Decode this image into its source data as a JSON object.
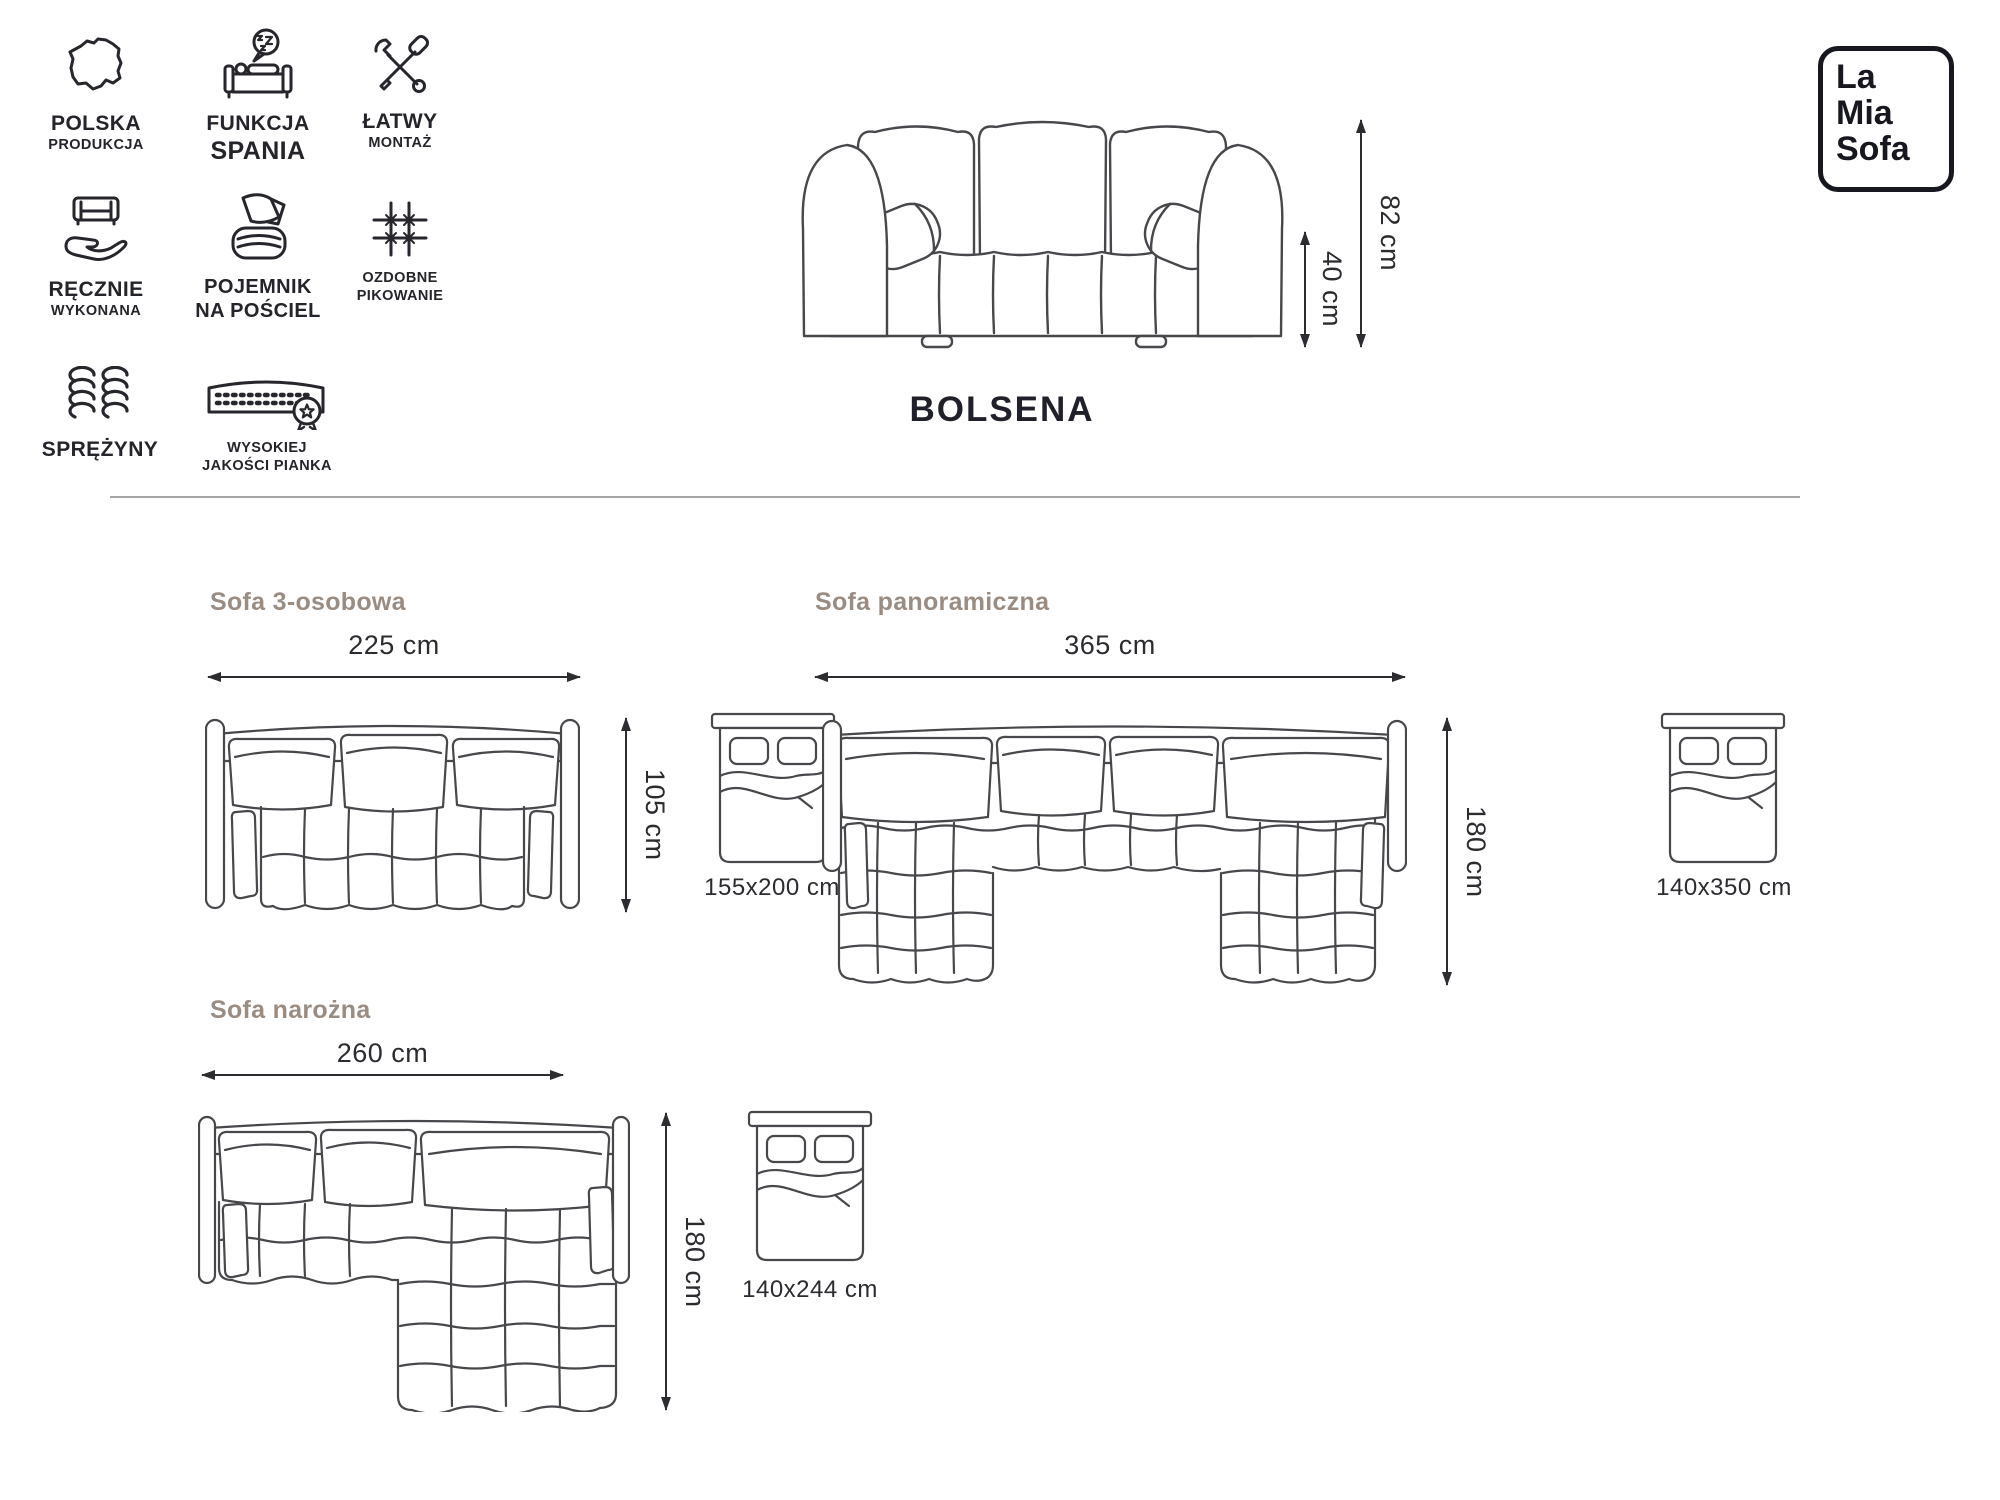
{
  "brand": {
    "lines": [
      "La",
      "Mia",
      "Sofa"
    ]
  },
  "product": {
    "name": "BOLSENA",
    "total_height": "82 cm",
    "seat_height": "40 cm"
  },
  "features": [
    {
      "line1": "POLSKA",
      "line2": "PRODUKCJA"
    },
    {
      "line1": "FUNKCJA",
      "line2": "SPANIA"
    },
    {
      "line1": "ŁATWY",
      "line2": "MONTAŻ"
    },
    {
      "line1": "RĘCZNIE",
      "line2": "WYKONANA"
    },
    {
      "line1": "POJEMNIK",
      "line2": "NA POŚCIEL"
    },
    {
      "line1": "OZDOBNE",
      "line2": "PIKOWANIE"
    },
    {
      "line1": "SPRĘŻYNY",
      "line2": ""
    },
    {
      "line1": "WYSOKIEJ",
      "line2": "JAKOŚCI PIANKA"
    }
  ],
  "variants": [
    {
      "name": "Sofa 3-osobowa",
      "width": "225 cm",
      "depth": "105 cm",
      "bed_size": "155x200 cm"
    },
    {
      "name": "Sofa panoramiczna",
      "width": "365 cm",
      "depth": "180 cm",
      "bed_size": "140x350 cm"
    },
    {
      "name": "Sofa narożna",
      "width": "260 cm",
      "depth": "180 cm",
      "bed_size": "140x244 cm"
    }
  ],
  "colors": {
    "ink": "#23232b",
    "line_art": "#48484c",
    "heading": "#9b8c81",
    "divider": "#a5a5a5"
  }
}
